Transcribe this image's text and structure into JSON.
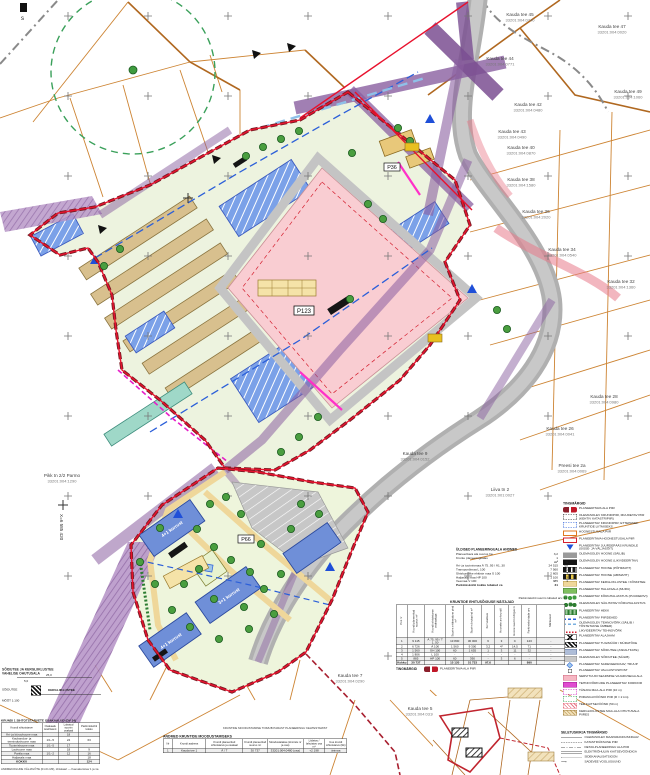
{
  "corner": {
    "mark": "s"
  },
  "coord_label": "X=6 585 420",
  "plot_tags": {
    "main": "P123",
    "south": "P66",
    "north": "P36"
  },
  "building_labels": [
    {
      "x": 172,
      "y": 529,
      "rot": -35,
      "label": "4+1 korrust"
    },
    {
      "x": 229,
      "y": 596,
      "rot": -35,
      "label": "3+1 korrust"
    },
    {
      "x": 171,
      "y": 641,
      "rot": -35,
      "label": "4+1 korrust"
    }
  ],
  "parcel_labels": [
    {
      "x": 520,
      "y": 16,
      "name": "Kauda tee 45",
      "code": "33201:004:0740"
    },
    {
      "x": 612,
      "y": 28,
      "name": "Kauda tee 47",
      "code": "33201:004:0020"
    },
    {
      "x": 500,
      "y": 60,
      "name": "Kauda tee 44",
      "code": "33201:004:0771"
    },
    {
      "x": 628,
      "y": 93,
      "name": "Kauda tee 49",
      "code": "33201:004:1060"
    },
    {
      "x": 528,
      "y": 106,
      "name": "Kauda tee 42",
      "code": "33201:004:0480"
    },
    {
      "x": 512,
      "y": 133,
      "name": "Kauda tee 43",
      "code": "33201:004:0490"
    },
    {
      "x": 521,
      "y": 149,
      "name": "Kauda tee 40",
      "code": "33201:004:0870"
    },
    {
      "x": 521,
      "y": 181,
      "name": "Kauda tee 38",
      "code": "33201:004:1580"
    },
    {
      "x": 536,
      "y": 213,
      "name": "Kauda tee 36",
      "code": "33201:004:2020"
    },
    {
      "x": 562,
      "y": 251,
      "name": "Kauda tee 34",
      "code": "33201:004:0540"
    },
    {
      "x": 621,
      "y": 283,
      "name": "Kauda tee 32",
      "code": "33201:004:1360"
    },
    {
      "x": 604,
      "y": 398,
      "name": "Kauda tee 28",
      "code": "33201:004:0980"
    },
    {
      "x": 560,
      "y": 430,
      "name": "Kauda tee 26",
      "code": "33201:004:0041"
    },
    {
      "x": 572,
      "y": 467,
      "name": "Preesi tee 2a",
      "code": "33201:004:0069"
    },
    {
      "x": 500,
      "y": 491,
      "name": "Liiva tn 2",
      "code": "33201:001:0027"
    },
    {
      "x": 62,
      "y": 477,
      "name": "Pikk tn 2/2 Parmo",
      "code": "33201:004:1290"
    },
    {
      "x": 415,
      "y": 455,
      "name": "Kauda tee 9",
      "code": "33201:004:0152"
    },
    {
      "x": 350,
      "y": 677,
      "name": "Kauda tee 7",
      "code": "33201:004:0290"
    },
    {
      "x": 420,
      "y": 710,
      "name": "Kauda tee 5",
      "code": "33201:004:0310"
    }
  ],
  "trees": [
    [
      246,
      156
    ],
    [
      263,
      147
    ],
    [
      281,
      139
    ],
    [
      299,
      131
    ],
    [
      368,
      204
    ],
    [
      383,
      219
    ],
    [
      120,
      249
    ],
    [
      104,
      266
    ],
    [
      350,
      299
    ],
    [
      398,
      128
    ],
    [
      410,
      141
    ],
    [
      352,
      153
    ],
    [
      497,
      310
    ],
    [
      507,
      329
    ],
    [
      318,
      417
    ],
    [
      299,
      437
    ],
    [
      281,
      452
    ],
    [
      210,
      504
    ],
    [
      226,
      497
    ],
    [
      241,
      514
    ],
    [
      197,
      529
    ],
    [
      214,
      547
    ],
    [
      231,
      560
    ],
    [
      250,
      572
    ],
    [
      199,
      569
    ],
    [
      184,
      584
    ],
    [
      214,
      599
    ],
    [
      244,
      607
    ],
    [
      264,
      589
    ],
    [
      281,
      574
    ],
    [
      261,
      544
    ],
    [
      291,
      529
    ],
    [
      301,
      504
    ],
    [
      319,
      514
    ],
    [
      172,
      610
    ],
    [
      190,
      627
    ],
    [
      219,
      639
    ],
    [
      249,
      629
    ],
    [
      274,
      614
    ],
    [
      155,
      584
    ],
    [
      140,
      562
    ],
    [
      160,
      528
    ]
  ],
  "balance": {
    "title": "ÜLDISED PLANEERINGUALA ANDMED",
    "top_rows": [
      {
        "label": "Planeeritava ala suurus ha",
        "value": "3,2"
      },
      {
        "label": "Krunte planeeringualas",
        "value": "1"
      }
    ],
    "unit1": "m²",
    "unit2": "%",
    "rows": [
      {
        "label": "Äri- ja tootmismaa Ä 75..95 / Ä1..30",
        "value": "24 515",
        "pct": "68"
      },
      {
        "label": "Transpordimaa L 100",
        "value": "7 560",
        "pct": "21"
      },
      {
        "label": "Ühiskondlike ehitiste maa Ü 100",
        "value": "2 605",
        "pct": "7"
      },
      {
        "label": "Haljasala maa HP 100",
        "value": "1 100",
        "pct": "3"
      },
      {
        "label": "Veemaa V 100",
        "value": "385",
        "pct": "1"
      }
    ],
    "footer": {
      "label": "Parkimiskohti kokku lubatud ca",
      "value": "31"
    }
  },
  "legend": {
    "title": "TINGMÄRGID",
    "items": [
      {
        "sw": "sw-redpair",
        "label": "PLANEERITAVA ALA PIIR"
      },
      {
        "sw": "sw-dashblack",
        "label": "OLEMASOLEV KRUNDIPIIR, MUUDETAV PIIR (KEHTIV KATASTRIPIIR)"
      },
      {
        "sw": "sw-dashblue",
        "label": "PLANEERITAV KRUNDIPIIR; ETTEPANEK KRUNTIDE LIITMISEKS"
      },
      {
        "sw": "sw-orangebox",
        "label": "HOONESTUSALA PIIR"
      },
      {
        "sw": "sw-redbox",
        "label": "PLANEERITAVA HOONESTUSALA PIIR"
      },
      {
        "sw": "sw-bluetri",
        "label": "PLANEERITAV JUURDEPÄÄS KRUNDILE (SISSE- JA VÄLJASÕIT)"
      },
      {
        "sw": "sw-graybar",
        "label": "OLEMASOLEV HOONE (SÄILIB)"
      },
      {
        "sw": "sw-blackbar",
        "label": "OLEMASOLEV HOONE (LIKVIDEERITAV)"
      },
      {
        "sw": "sw-blackstripe",
        "label": "PLANEERITAV HOONE (PÕHIMAHT)"
      },
      {
        "sw": "sw-yellowstripe",
        "label": "PLANEERITAV HOONE (ABIMAHT)"
      },
      {
        "sw": "sw-yellowbar",
        "label": "PLANEERITAV KERGLIIKLUSTEE / KÕNNITEE"
      },
      {
        "sw": "sw-greenbar",
        "label": "PLANEERITAV HALJASALA (MURU)"
      },
      {
        "sw": "sw-trees",
        "label": "PLANEERITAV KÕRGHALJASTUS (PUUDERIVI)"
      },
      {
        "sw": "sw-treerow",
        "label": "OLEMASOLEV SÄILITATAV KÕRGHALJASTUS"
      },
      {
        "sw": "sw-hedge",
        "label": "PLANEERITAV HEKK"
      },
      {
        "sw": "sw-bluewave",
        "label": "PLANEERITAV PIIRDEAED"
      },
      {
        "sw": "sw-bluewave2",
        "label": "OLEMASOLEV TEHNOVÕRK (SÄILIB / TÕSTETAKSE ÜMBER)"
      },
      {
        "sw": "sw-reddot",
        "label": "LIKVIDEERITAV TEHNOVÕRK"
      },
      {
        "sw": "sw-trafo",
        "label": "PLANEERITAV ALAJAAM"
      },
      {
        "sw": "sw-blackhatchbox",
        "label": "PLANEERITAV TUGIMÜÜR / MÜRATÕKE"
      },
      {
        "sw": "sw-bluegraybar",
        "label": "PLANEERITAV SÕIDUTEE (ASFALTKATE)"
      },
      {
        "sw": "sw-graybar2",
        "label": "OLEMASOLEV SÕIDUTEE (SÄILIB)"
      },
      {
        "sw": "sw-diamond",
        "label": "PLANEERITAV SADEVEEKRAAV; TRUUP"
      },
      {
        "sw": "sw-lamp",
        "label": "PLANEERITAV VALGUSTUSPOST"
      },
      {
        "sw": "sw-pinkbox",
        "label": "SERVITUUDI SEADMISE VAJADUSEGA ALA"
      },
      {
        "sw": "sw-magentabox",
        "label": "TEHNOVÕRKUDE PLANEERITAV KORIDOR"
      },
      {
        "sw": "sw-magentadash",
        "label": "TÄNAVA MAA-ALA PIIR (10 m)"
      },
      {
        "sw": "sw-greendash",
        "label": "PIIRANGUVÖÖNDI PIIR (R = 2 km)"
      },
      {
        "sw": "sw-pinkhatch",
        "label": "TEE KAITSEVÖÖND (50 m)"
      },
      {
        "sw": "sw-tanhatch",
        "label": "KERGLIIKLUSTEE MAA-ALA OHUTUSALA PIIRES"
      }
    ]
  },
  "line_legend": {
    "title": "SELETUSKIRJA TINGMÄRGID",
    "items": [
      {
        "style": "ls-solid",
        "label": "OLEMASOLEV MAAPARANDUSKRAAV"
      },
      {
        "style": "ls-dashed",
        "label": "KATASTRIÜKSUSE PIIR"
      },
      {
        "style": "ls-dashdot",
        "label": "DETAILPLANEERINGU ALA PIIR"
      },
      {
        "style": "ls-double",
        "label": "ELEKTRIÕHULIIN KAITSEVÖÖNDIGA"
      },
      {
        "style": "ls-dotted",
        "label": "SIDEKANALISATSIOON"
      },
      {
        "style": "ls-arrow",
        "label": "SADEVEE VOOLUSUUND"
      }
    ]
  },
  "main_table": {
    "note": "Parkimiskohti suurim lubatud arv: 31",
    "title": "KRUNTIDE EHITUSÕIGUSE NÄITAJAD",
    "columns": [
      "Pos nr",
      "Krundi planeeritud suurus m²",
      "Krundi sihtotstarve osakaaluga",
      "Suurim ehitisealune pind m²",
      "Suurim brutopind m²",
      "Korruselisus",
      "Hoonete arv krundil",
      "Hoone suurim kõrgus m",
      "Parkimiskohtade arv",
      "Märkused"
    ],
    "rows": [
      [
        "1",
        "9 115",
        "Ä 75..95 / T 1..50",
        "13 800",
        "30 000",
        "6",
        "3",
        "C",
        "123",
        "-"
      ],
      [
        "2",
        "6 726",
        "Ä 100",
        "1 560",
        "9 300",
        "3,2",
        "4*",
        "14,5",
        "71",
        "-"
      ],
      [
        "3",
        "1 560",
        "ÜH 100",
        "60",
        "1 655",
        "1",
        "3",
        "11",
        "32",
        "-"
      ],
      [
        "4",
        "1 806",
        "L 100",
        "-",
        "-",
        "-",
        "-",
        "-",
        "-",
        "-"
      ],
      [
        "5",
        "885",
        "HP 100",
        "60",
        "390",
        "-",
        "3",
        "6",
        "-",
        "-"
      ]
    ],
    "total": [
      "Kokku",
      "30 737",
      "",
      "15 120",
      "51 733",
      "97,6",
      "",
      "",
      "890",
      ""
    ],
    "legend_header": "TINGMÄRGID",
    "legend_item": "PLANEERITAVA ALA PIIR"
  },
  "share_table": {
    "title": "KRUNDI 1 SIHTOTSTARVETE OSAKAALUD (DV 34)",
    "columns": [
      "Krundi sihtotstarve",
      "Osakaalu koefitsient",
      "Lubatud suurim osakaal",
      "Parkimiskohti kokku"
    ],
    "rows": [
      [
        "Äri- ja büroohoone maa",
        "",
        "18",
        ""
      ],
      [
        "Kaubandus- ja teenindushoone maa",
        "1/1–5",
        "24",
        "63"
      ],
      [
        "Tootmishoone maa",
        "1/1–5",
        "17",
        ""
      ],
      [
        "Laohoone maa",
        "",
        "18",
        "9"
      ],
      [
        "Parkla maa",
        "1/1–2",
        "12",
        "16"
      ],
      [
        "Haljasala maa",
        "",
        "",
        "18"
      ]
    ],
    "total": [
      "KOKKU",
      "",
      "",
      "124"
    ]
  },
  "formation_table": {
    "pre_note": "KRUNTIDE MOODUSTAMINE TOIMUB PÄRAST PLANEERINGU KEHTESTAMIST",
    "title": "ANDMED KRUNTIDE MOODUSTAMISEKS",
    "columns": [
      "Nr",
      "Krundi aadress",
      "Krundi planeeritud sihtotstarve ja osakaal",
      "Krundi planeeritud suurus m²",
      "Moodustatakse (kinnistu nr ja osa)",
      "Liidetav / lahutatav osa m²",
      "Uue krundi sihtotstarve (liik)"
    ],
    "rows": [
      [
        "1",
        "Kauda tee 1",
        "Ä / T",
        "30 737",
        "33201:004:0480 (osa)",
        "+2 198",
        "ärimaa"
      ]
    ]
  },
  "section": {
    "title_line1": "SÕIDUTEE JA KERGLIIKLUSTEE",
    "title_line2": "VAHELISE OHUTUSALA",
    "dim_total": "25,0",
    "dim_left": "5,0",
    "label_left": "SÕIDUTEE",
    "label_right": "KERGLIIKLUSTEE",
    "scale": "MÕÕT 1:100"
  },
  "footer_note": "ANDMEKOGUDE VÄLJAVÕTE (01.01.M3), ühiskaart — Kaevala tänav 1 ja 1a"
}
